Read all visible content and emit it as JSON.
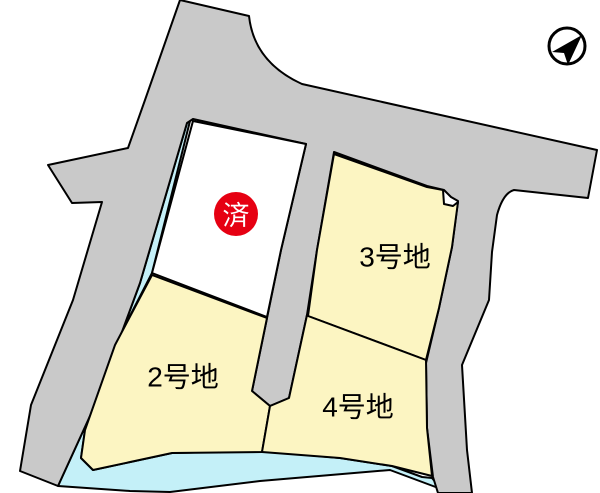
{
  "map": {
    "kind": "residential-lot-plan",
    "colors": {
      "road": "#c9c9c9",
      "lot": "#fcf5c2",
      "water": "#c4f0f8",
      "sold_badge": "#e60012",
      "sold_text": "#ffffff",
      "label_text": "#000000",
      "outline": "#000000",
      "background": "#ffffff"
    },
    "lots": [
      {
        "name": "lot-1",
        "label": "",
        "badge": "済"
      },
      {
        "name": "lot-2",
        "label": "2号地"
      },
      {
        "name": "lot-3",
        "label": "3号地"
      },
      {
        "name": "lot-4",
        "label": "4号地"
      }
    ],
    "sold_badge": {
      "text": "済"
    },
    "compass": {
      "icon": "north-arrow"
    }
  }
}
